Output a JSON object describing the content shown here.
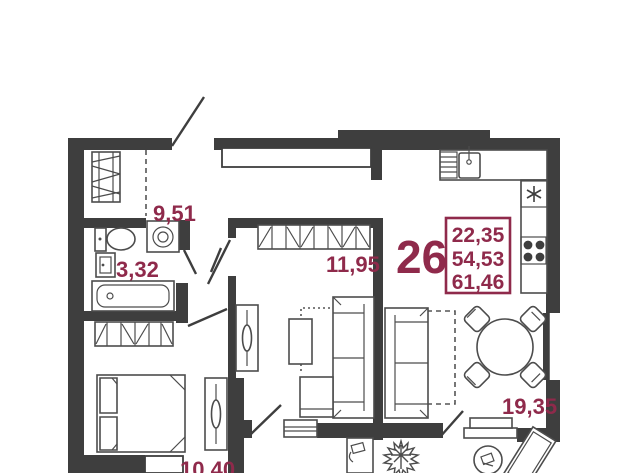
{
  "plan": {
    "type": "apartment-floor-plan",
    "unit": {
      "number": "26",
      "area_living": "22,35",
      "area_total": "54,53",
      "area_overall": "61,46"
    },
    "rooms": [
      {
        "name": "hall",
        "area": "9,51"
      },
      {
        "name": "bathroom",
        "area": "3,32"
      },
      {
        "name": "room",
        "area": "11,95"
      },
      {
        "name": "bedroom",
        "area": "10,40"
      },
      {
        "name": "kitchen-living-room",
        "area": "19,35"
      }
    ],
    "colors": {
      "wall": "#3e3e3e",
      "accent": "#8f2a4b",
      "background": "#ffffff"
    }
  }
}
